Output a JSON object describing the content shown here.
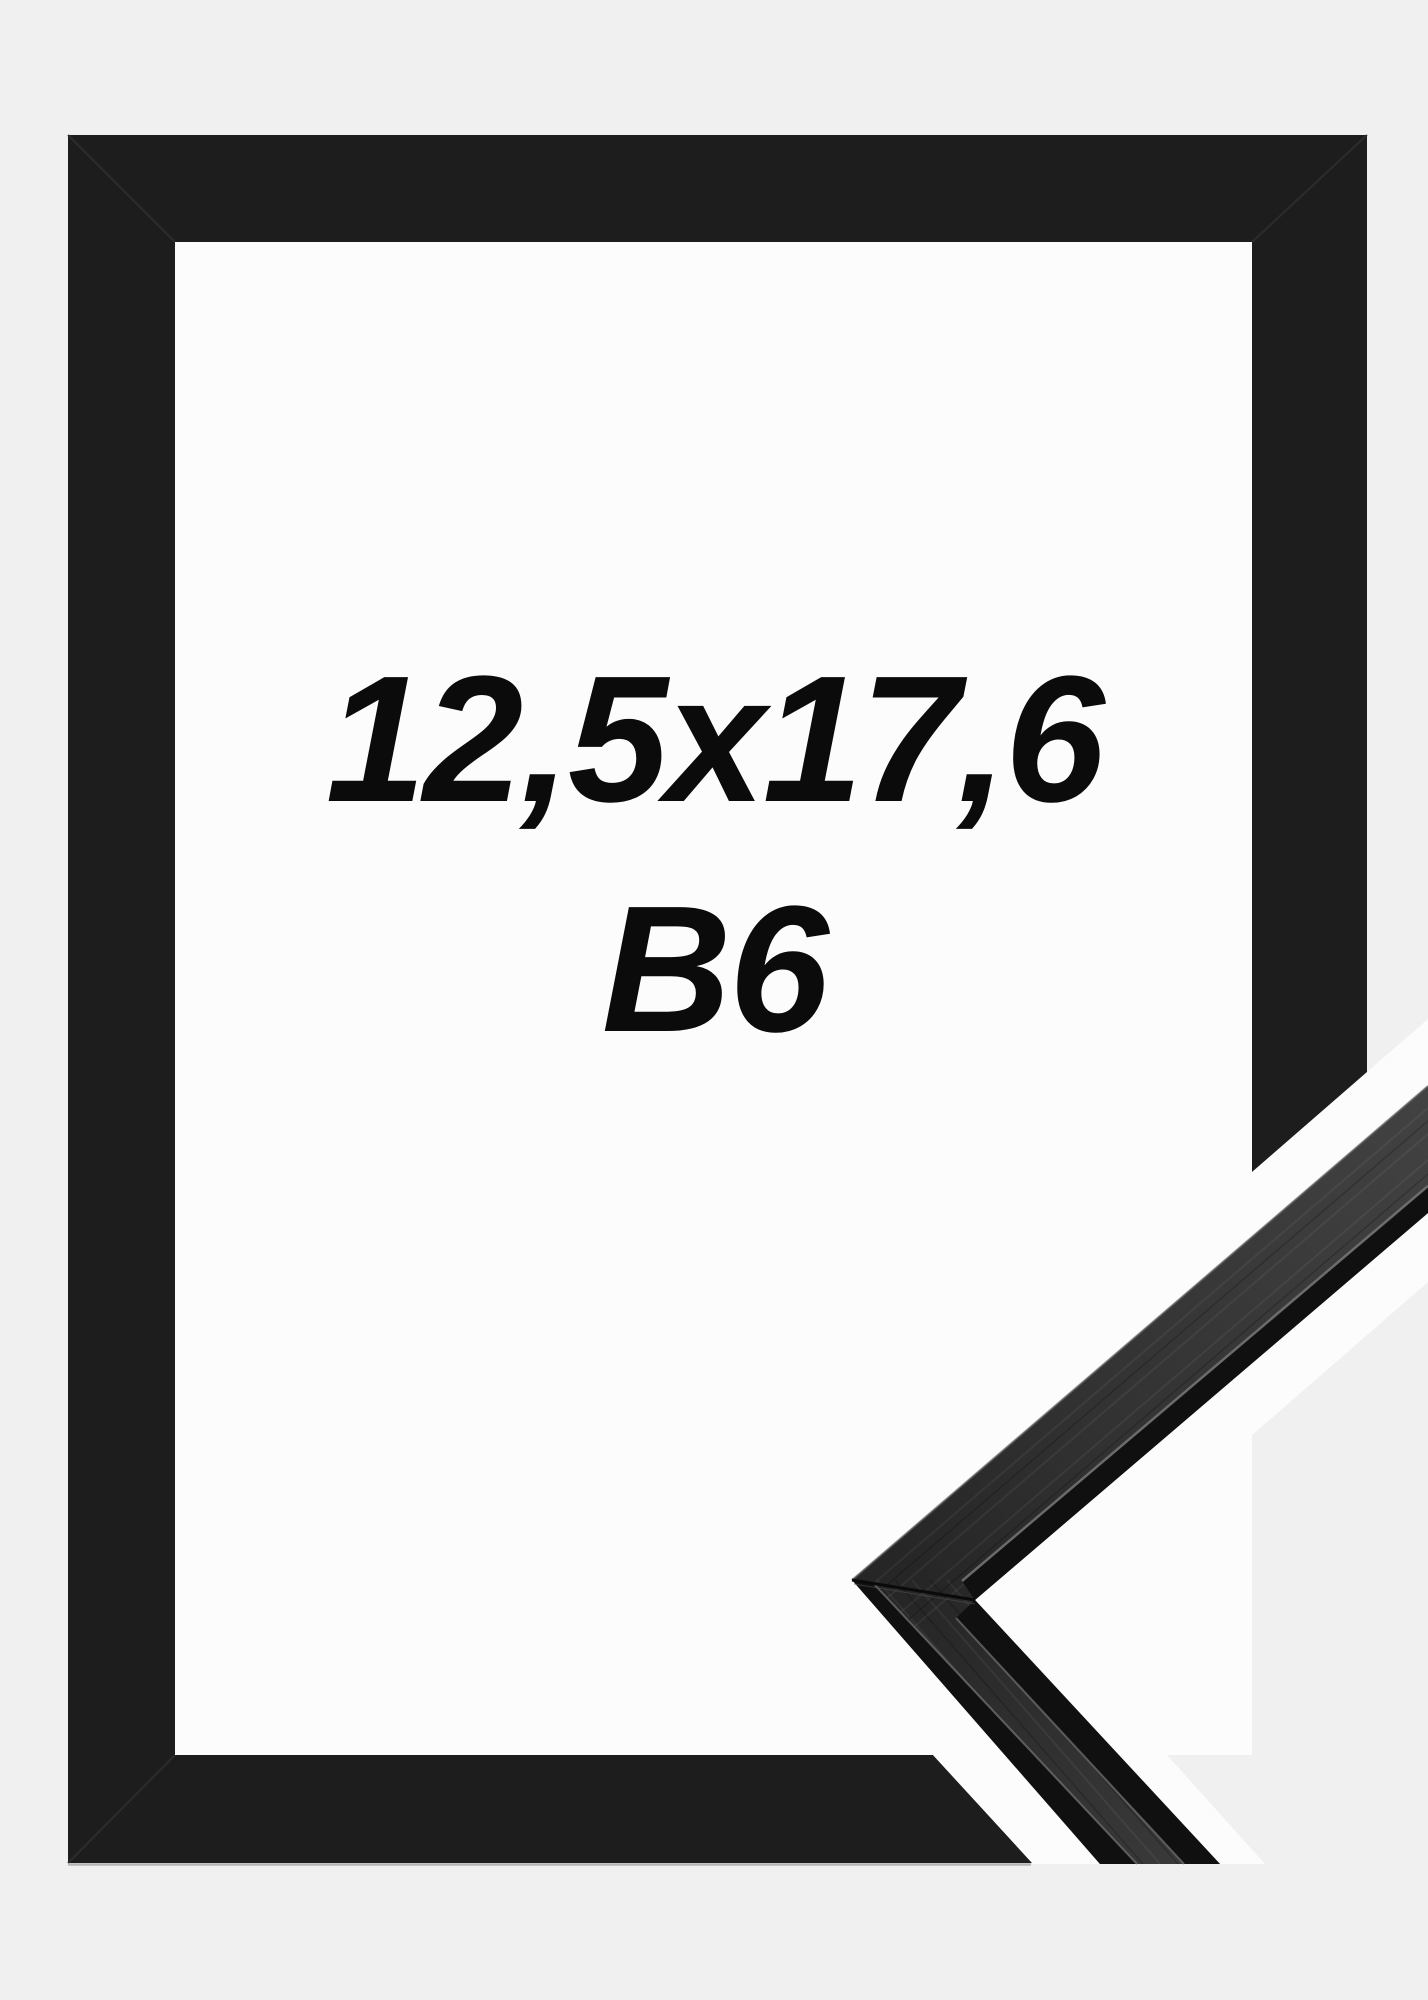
{
  "page": {
    "background_color": "#f0f0f1"
  },
  "image": {
    "size_label": "12,5x17,6",
    "format_label": "B6",
    "colors": {
      "frame_black": "#1d1d1d",
      "interior_white": "#fcfcfc",
      "background_gray": "#f0f0f1",
      "sample_face_gray": "#383838",
      "sample_edge_black": "#101010",
      "text_color": "#0b0b0b"
    }
  }
}
